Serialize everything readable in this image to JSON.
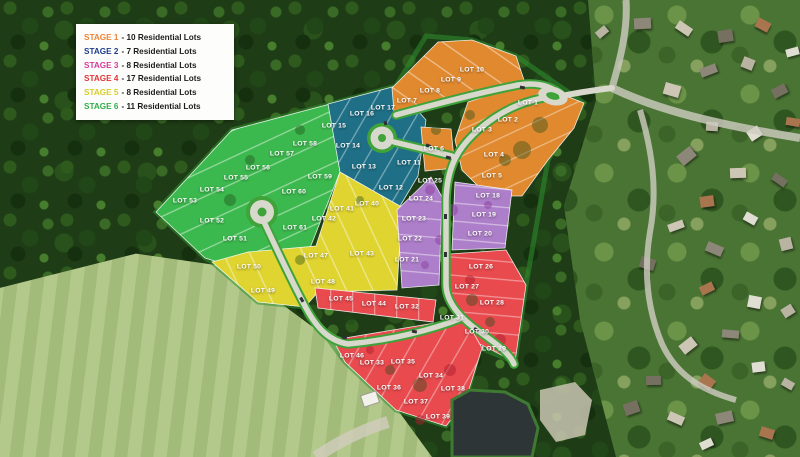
{
  "legend": {
    "items": [
      {
        "label": "STAGE 1",
        "desc": "- 10 Residential Lots",
        "color": "#ef8435"
      },
      {
        "label": "STAGE 2",
        "desc": "- 7 Residential Lots",
        "color": "#1d3c8c"
      },
      {
        "label": "STAGE 3",
        "desc": "- 8 Residential Lots",
        "color": "#d63a9b"
      },
      {
        "label": "STAGE 4",
        "desc": "- 17 Residential Lots",
        "color": "#e23438"
      },
      {
        "label": "STAGE 5",
        "desc": "- 8 Residential Lots",
        "color": "#d9ce26"
      },
      {
        "label": "STAGE 6",
        "desc": "- 11 Residential Lots",
        "color": "#2fae4a"
      }
    ]
  },
  "stage_colors": {
    "1": "#e0892f",
    "2": "#1f6f86",
    "3": "#ad7ec9",
    "4": "#e84a4e",
    "5": "#e0d430",
    "6": "#3cb94e"
  },
  "map_colors": {
    "road": "#d9d8cd",
    "road_edge": "#3fa33a",
    "forest": "#1d3a14",
    "field": "#aac57e",
    "pond": "#2d3537"
  },
  "lots": [
    {
      "label": "LOT 1",
      "stage": 1,
      "x": 528,
      "y": 103
    },
    {
      "label": "LOT 2",
      "stage": 1,
      "x": 508,
      "y": 120
    },
    {
      "label": "LOT 3",
      "stage": 1,
      "x": 482,
      "y": 130
    },
    {
      "label": "LOT 4",
      "stage": 1,
      "x": 494,
      "y": 155
    },
    {
      "label": "LOT 5",
      "stage": 1,
      "x": 492,
      "y": 176
    },
    {
      "label": "LOT 6",
      "stage": 1,
      "x": 434,
      "y": 149
    },
    {
      "label": "LOT 7",
      "stage": 1,
      "x": 407,
      "y": 101
    },
    {
      "label": "LOT 8",
      "stage": 1,
      "x": 430,
      "y": 91
    },
    {
      "label": "LOT 9",
      "stage": 1,
      "x": 451,
      "y": 80
    },
    {
      "label": "LOT 10",
      "stage": 1,
      "x": 472,
      "y": 70
    },
    {
      "label": "LOT 11",
      "stage": 2,
      "x": 409,
      "y": 163
    },
    {
      "label": "LOT 12",
      "stage": 2,
      "x": 391,
      "y": 188
    },
    {
      "label": "LOT 13",
      "stage": 2,
      "x": 364,
      "y": 167
    },
    {
      "label": "LOT 14",
      "stage": 2,
      "x": 348,
      "y": 146
    },
    {
      "label": "LOT 15",
      "stage": 2,
      "x": 334,
      "y": 126
    },
    {
      "label": "LOT 16",
      "stage": 2,
      "x": 362,
      "y": 114
    },
    {
      "label": "LOT 17",
      "stage": 2,
      "x": 383,
      "y": 108
    },
    {
      "label": "LOT 18",
      "stage": 3,
      "x": 488,
      "y": 196
    },
    {
      "label": "LOT 19",
      "stage": 3,
      "x": 484,
      "y": 215
    },
    {
      "label": "LOT 20",
      "stage": 3,
      "x": 480,
      "y": 234
    },
    {
      "label": "LOT 21",
      "stage": 3,
      "x": 407,
      "y": 260
    },
    {
      "label": "LOT 22",
      "stage": 3,
      "x": 410,
      "y": 239
    },
    {
      "label": "LOT 23",
      "stage": 3,
      "x": 414,
      "y": 219
    },
    {
      "label": "LOT 24",
      "stage": 3,
      "x": 421,
      "y": 199
    },
    {
      "label": "LOT 25",
      "stage": 3,
      "x": 430,
      "y": 181
    },
    {
      "label": "LOT 26",
      "stage": 4,
      "x": 481,
      "y": 267
    },
    {
      "label": "LOT 27",
      "stage": 4,
      "x": 467,
      "y": 287
    },
    {
      "label": "LOT 28",
      "stage": 4,
      "x": 492,
      "y": 303
    },
    {
      "label": "LOT 29",
      "stage": 4,
      "x": 494,
      "y": 349
    },
    {
      "label": "LOT 30",
      "stage": 4,
      "x": 477,
      "y": 332
    },
    {
      "label": "LOT 31",
      "stage": 4,
      "x": 452,
      "y": 318
    },
    {
      "label": "LOT 32",
      "stage": 4,
      "x": 407,
      "y": 307
    },
    {
      "label": "LOT 33",
      "stage": 4,
      "x": 372,
      "y": 363
    },
    {
      "label": "LOT 34",
      "stage": 4,
      "x": 431,
      "y": 376
    },
    {
      "label": "LOT 35",
      "stage": 4,
      "x": 403,
      "y": 362
    },
    {
      "label": "LOT 36",
      "stage": 4,
      "x": 389,
      "y": 388
    },
    {
      "label": "LOT 37",
      "stage": 4,
      "x": 416,
      "y": 402
    },
    {
      "label": "LOT 38",
      "stage": 4,
      "x": 453,
      "y": 389
    },
    {
      "label": "LOT 39",
      "stage": 4,
      "x": 438,
      "y": 417
    },
    {
      "label": "LOT 44",
      "stage": 4,
      "x": 374,
      "y": 304
    },
    {
      "label": "LOT 45",
      "stage": 4,
      "x": 341,
      "y": 299
    },
    {
      "label": "LOT 46",
      "stage": 4,
      "x": 352,
      "y": 356
    },
    {
      "label": "LOT 40",
      "stage": 5,
      "x": 367,
      "y": 204
    },
    {
      "label": "LOT 41",
      "stage": 5,
      "x": 342,
      "y": 209
    },
    {
      "label": "LOT 42",
      "stage": 5,
      "x": 324,
      "y": 219
    },
    {
      "label": "LOT 43",
      "stage": 5,
      "x": 362,
      "y": 254
    },
    {
      "label": "LOT 47",
      "stage": 5,
      "x": 316,
      "y": 256
    },
    {
      "label": "LOT 48",
      "stage": 5,
      "x": 323,
      "y": 282
    },
    {
      "label": "LOT 49",
      "stage": 5,
      "x": 263,
      "y": 291
    },
    {
      "label": "LOT 50",
      "stage": 5,
      "x": 249,
      "y": 267
    },
    {
      "label": "LOT 51",
      "stage": 6,
      "x": 235,
      "y": 239
    },
    {
      "label": "LOT 52",
      "stage": 6,
      "x": 212,
      "y": 221
    },
    {
      "label": "LOT 53",
      "stage": 6,
      "x": 185,
      "y": 201
    },
    {
      "label": "LOT 54",
      "stage": 6,
      "x": 212,
      "y": 190
    },
    {
      "label": "LOT 55",
      "stage": 6,
      "x": 236,
      "y": 178
    },
    {
      "label": "LOT 56",
      "stage": 6,
      "x": 258,
      "y": 168
    },
    {
      "label": "LOT 57",
      "stage": 6,
      "x": 282,
      "y": 154
    },
    {
      "label": "LOT 58",
      "stage": 6,
      "x": 305,
      "y": 144
    },
    {
      "label": "LOT 59",
      "stage": 6,
      "x": 320,
      "y": 177
    },
    {
      "label": "LOT 60",
      "stage": 6,
      "x": 294,
      "y": 192
    },
    {
      "label": "LOT 61",
      "stage": 6,
      "x": 295,
      "y": 228
    }
  ]
}
